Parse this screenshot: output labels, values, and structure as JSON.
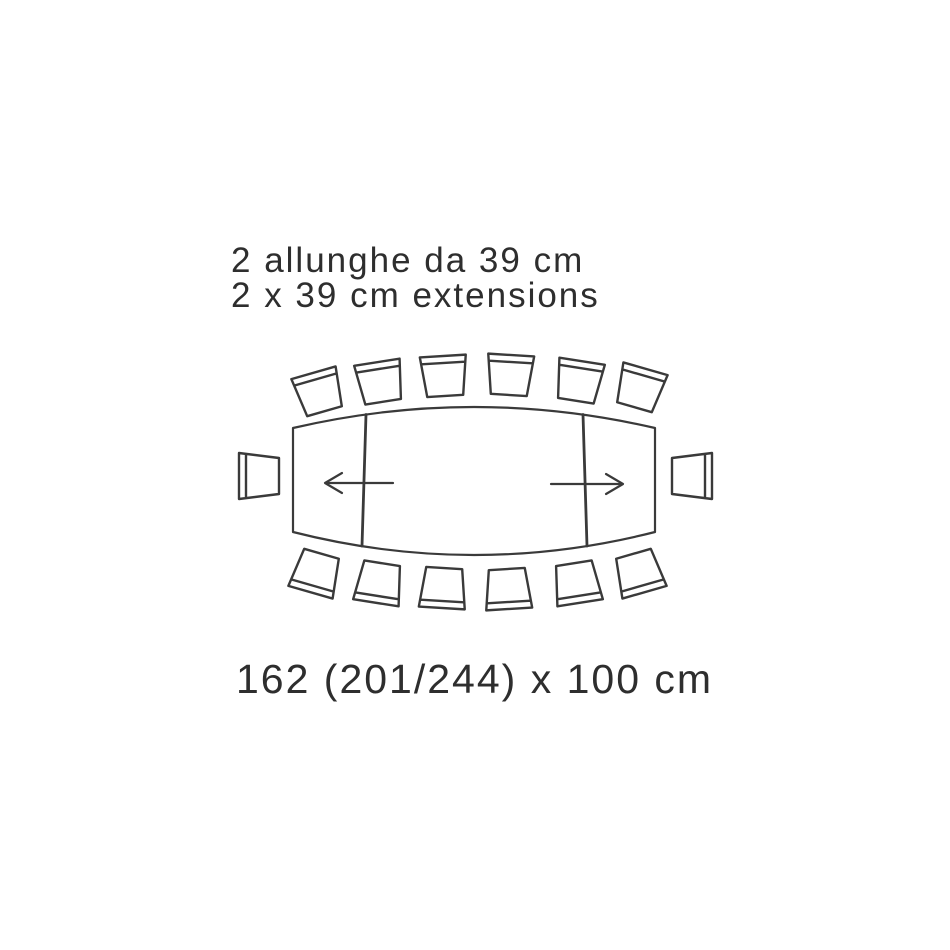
{
  "annotation": {
    "line1": "2 allunghe da 39 cm",
    "line2": "2 x 39 cm extensions"
  },
  "dimension_label": "162 (201/244) x 100 cm",
  "diagram": {
    "type": "extendable-table-top-view",
    "table_shape": "barrel",
    "extension_leaves": 2,
    "chairs": {
      "top": 6,
      "bottom": 6,
      "left_end": 1,
      "right_end": 1,
      "total": 14
    },
    "colors": {
      "background": "#ffffff",
      "stroke": "#3a3a3a",
      "text": "#2e2e2e"
    }
  }
}
